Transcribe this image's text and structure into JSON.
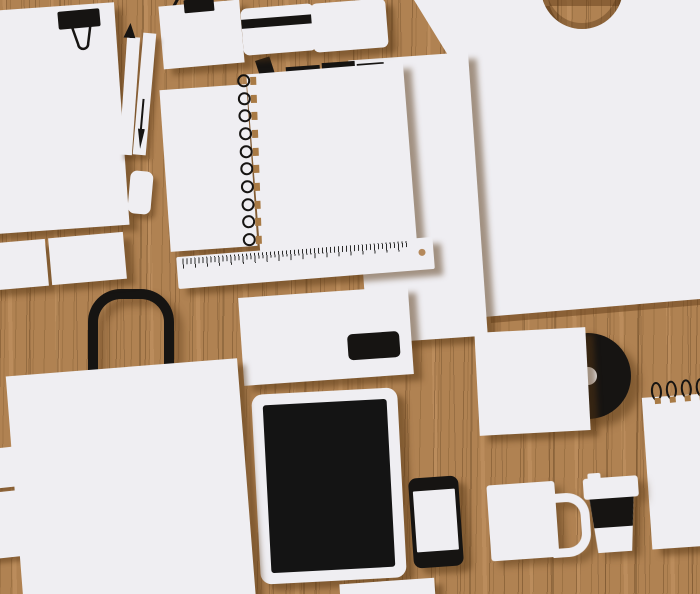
{
  "scene": {
    "type": "flat vector flat-lay illustration",
    "surface": "wood grain desk, vertical grain lines",
    "style": "blank white branding/stationery mockup, soft brown drop shadows offset down-right",
    "text_content": "none — every item is blank"
  },
  "palette": {
    "wood_base": "#b08252",
    "wood_grain_dark": "#7a5530",
    "wood_grain_light": "#c69765",
    "object_shadow": "rgba(86,53,20,0.5)",
    "paper_white": "#efeef2",
    "ink_black": "#161412",
    "binding_tan": "#a87a45"
  },
  "counts": {
    "notebook_spiral_loops": 10,
    "notepad_spiral_loops": 4,
    "pencil_row_items": 4,
    "business_cards_left": 2
  },
  "objects": [
    {
      "id": "paper-top-left",
      "label": "letter paper with black binder clip, top-left, partially off-canvas"
    },
    {
      "id": "pencil",
      "label": "white pencil with black sharpened tip pointing up"
    },
    {
      "id": "pen",
      "label": "white ballpoint pen with black ink cartridge and nib"
    },
    {
      "id": "eraser",
      "label": "white rounded eraser"
    },
    {
      "id": "hang-tag",
      "label": "white tag with black clip and lanyard strings exiting top edge"
    },
    {
      "id": "credit-card",
      "label": "white plastic card with black magnetic stripe"
    },
    {
      "id": "business-card-top",
      "label": "blank rounded business card"
    },
    {
      "id": "pencil-row",
      "label": "row of four black pencils/pens tucked under the notebook"
    },
    {
      "id": "narrow-sheet",
      "label": "narrow blank sheet left of notebook"
    },
    {
      "id": "notebook",
      "label": "spiral-bound notebook, wire loops on left edge"
    },
    {
      "id": "middle-paper",
      "label": "tall sheet behind notebook/ruler/envelope"
    },
    {
      "id": "ruler",
      "label": "white ruler with tick marks and hanging hole at right end"
    },
    {
      "id": "envelope",
      "label": "white DL envelope with black address window"
    },
    {
      "id": "tablet",
      "label": "white tablet with black screen"
    },
    {
      "id": "phone",
      "label": "black smartphone with white screen"
    },
    {
      "id": "card-left-row",
      "label": "two blank business cards at left edge"
    },
    {
      "id": "shopping-bag",
      "label": "white paper shopping bag with black arch handle"
    },
    {
      "id": "slivers",
      "label": "two white card corners poking in from the left edge"
    },
    {
      "id": "right-paper",
      "label": "large white sheet filling upper right with circular punched hole showing wood"
    },
    {
      "id": "record-sleeve",
      "label": "white square sleeve with black vinyl record sticking out right"
    },
    {
      "id": "notepad",
      "label": "spiral notepad at right edge, wire loops on top"
    },
    {
      "id": "mug",
      "label": "white coffee mug, handle on right"
    },
    {
      "id": "cup",
      "label": "white takeaway coffee cup with black sleeve band and lid"
    },
    {
      "id": "bottom-sliver",
      "label": "paper edge peeking at bottom center"
    }
  ]
}
